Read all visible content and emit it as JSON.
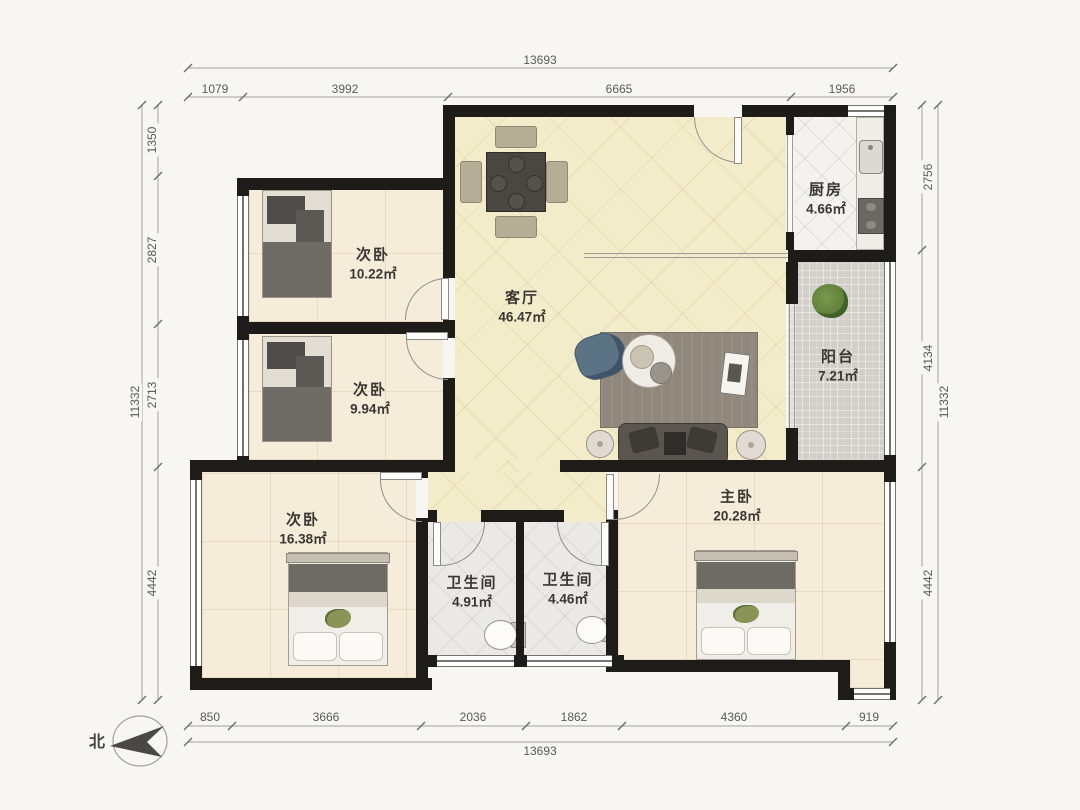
{
  "compass": {
    "label": "北"
  },
  "rooms": {
    "bedroom1": {
      "name": "次卧",
      "area": "10.22㎡"
    },
    "bedroom2": {
      "name": "次卧",
      "area": "9.94㎡"
    },
    "bedroom3": {
      "name": "次卧",
      "area": "16.38㎡"
    },
    "living": {
      "name": "客厅",
      "area": "46.47㎡"
    },
    "kitchen": {
      "name": "厨房",
      "area": "4.66㎡"
    },
    "balcony": {
      "name": "阳台",
      "area": "7.21㎡"
    },
    "bath1": {
      "name": "卫生间",
      "area": "4.91㎡"
    },
    "bath2": {
      "name": "卫生间",
      "area": "4.46㎡"
    },
    "master": {
      "name": "主卧",
      "area": "20.28㎡"
    }
  },
  "dimensions": {
    "top": {
      "total": "13693",
      "segments": [
        "1079",
        "3992",
        "6665",
        "1956"
      ]
    },
    "bottom": {
      "total": "13693",
      "segments": [
        "850",
        "3666",
        "2036",
        "1862",
        "4360",
        "919"
      ]
    },
    "left": {
      "total": "11332",
      "segments": [
        "1350",
        "2827",
        "2713",
        "4442"
      ]
    },
    "right": {
      "total": "11332",
      "segments": [
        "2756",
        "4134",
        "4442"
      ]
    }
  },
  "colors": {
    "wall": "#1e1c19",
    "bedroom_floor": "#f5ecd9",
    "living_floor": "#f2ecca",
    "kitchen_floor": "#f3f2ef",
    "bath_floor": "#ebe9e6",
    "balcony_floor": "#d2cfc9",
    "dimension_text": "#5a5a5a"
  }
}
